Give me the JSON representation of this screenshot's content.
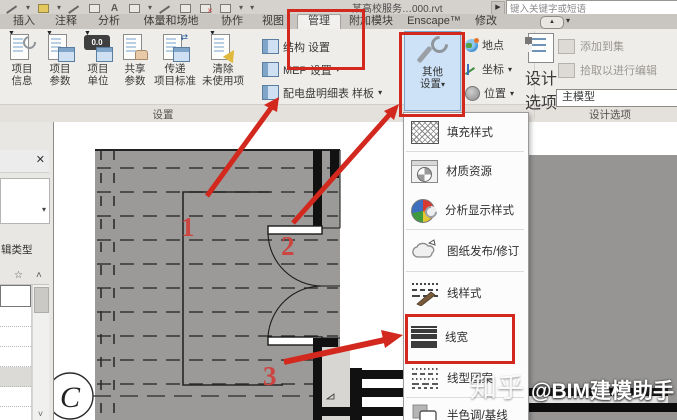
{
  "colors": {
    "annotation_red": "#d2281e",
    "other_settings_highlight": "#cde2f7",
    "plan_gray": "#9b9a98",
    "active_tab_bg": "#f2f0ee"
  },
  "glyphs": {
    "dropdown": "▾",
    "close": "✕",
    "play": "▶",
    "pill_up": "▲",
    "up_caret": "˄",
    "down_caret": "˅",
    "star": "☆",
    "text_tool": "A",
    "red_x": "✕"
  },
  "title_bar": {
    "title": "某高校服务…000.rvt",
    "search_value": "键入关键字或短语",
    "qat_icons": [
      "undo-icon",
      "measure-icon",
      "aligned-dimension-icon",
      "tag-icon",
      "text-icon",
      "default-3d-view-icon",
      "section-icon",
      "thin-lines-icon",
      "close-hidden-windows-icon",
      "switch-windows-icon"
    ]
  },
  "tabs": [
    "插入",
    "注释",
    "分析",
    "体量和场地",
    "协作",
    "视图",
    "管理",
    "附加模块",
    "Enscape™",
    "修改"
  ],
  "ribbon": {
    "settings_panel_label": "设置",
    "design_options_panel_label": "设计选项",
    "big_buttons": [
      {
        "l1": "项目",
        "l2": "信息"
      },
      {
        "l1": "项目",
        "l2": "参数"
      },
      {
        "l1": "项目",
        "l2": "单位",
        "icon_text": "0.0"
      },
      {
        "l1": "共享",
        "l2": "参数"
      },
      {
        "l1": "传递",
        "l2": "项目标准"
      },
      {
        "l1": "清除",
        "l2": "未使用项"
      }
    ],
    "small_buttons": [
      {
        "label": "结构 设置",
        "arrow": ""
      },
      {
        "label": "MEP 设置",
        "arrow": "▾"
      },
      {
        "label": "配电盘明细表 样板",
        "arrow": "▾"
      }
    ],
    "other_settings": {
      "l1": "其他",
      "l2": "设置",
      "arrow": "▾"
    },
    "location_buttons": [
      {
        "label": "地点",
        "arrow": ""
      },
      {
        "label": "坐标",
        "arrow": "▾"
      },
      {
        "label": "位置",
        "arrow": "▾"
      }
    ],
    "design_options_button": {
      "l1": "设计",
      "l2": "选项"
    },
    "add_to_set": "添加到集",
    "pick_to_edit": "拾取以进行编辑",
    "main_model": "主模型"
  },
  "menu": {
    "items": [
      {
        "label": "填充样式",
        "icon": "fill-patterns-icon"
      },
      {
        "label": "材质资源",
        "icon": "material-assets-icon"
      },
      {
        "label": "分析显示样式",
        "icon": "analysis-display-styles-icon"
      },
      {
        "label": "图纸发布/修订",
        "icon": "sheet-issues-revisions-icon"
      },
      {
        "label": "线样式",
        "icon": "line-styles-icon"
      },
      {
        "label": "线宽",
        "icon": "line-weights-icon"
      },
      {
        "label": "线型图案",
        "icon": "line-patterns-icon"
      },
      {
        "label": "半色调/基线",
        "icon": "halftone-underlay-icon"
      }
    ]
  },
  "properties_panel": {
    "edit_type_clipped": "辑类型"
  },
  "canvas": {
    "grid_bubble": "C",
    "callouts": [
      {
        "label": "1"
      },
      {
        "label": "2"
      },
      {
        "label": "3"
      }
    ]
  },
  "watermark": {
    "site": "知乎",
    "handle": "@BIM建模助手"
  }
}
